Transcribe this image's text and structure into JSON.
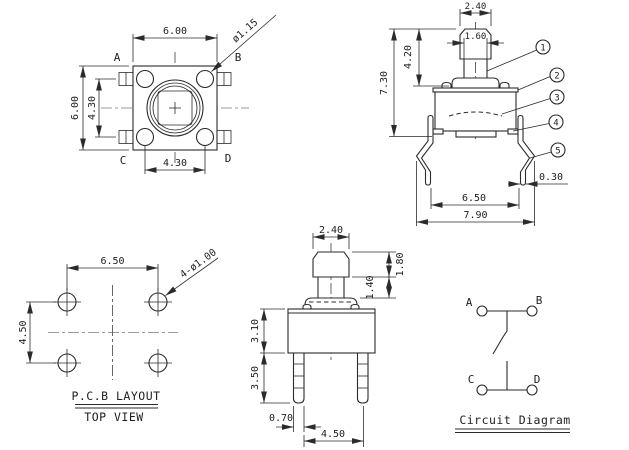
{
  "colors": {
    "line": "#2b2b2b",
    "centerline_gray": "#9a9a9a",
    "centerline_dark": "#555555",
    "background": "#ffffff"
  },
  "top_view": {
    "dim_width": "6.00",
    "dim_height": "6.00",
    "dim_pin_spacing_v": "4.30",
    "dim_pin_spacing_h": "4.30",
    "dim_actuator_dia": "ø1.15",
    "terminal_a": "A",
    "terminal_b": "B",
    "terminal_c": "C",
    "terminal_d": "D"
  },
  "front_view": {
    "dim_cap_width": "2.40",
    "dim_stem_width": "1.60",
    "dim_height_to_base": "4.20",
    "dim_total_height": "7.30",
    "dim_body_width": "6.50",
    "dim_lead_span": "7.90",
    "dim_lead_thickness": "0.30",
    "callouts": {
      "c1": "1",
      "c2": "2",
      "c3": "3",
      "c4": "4",
      "c5": "5"
    }
  },
  "pcb_layout": {
    "title": "P.C.B LAYOUT",
    "subtitle": "TOP VIEW",
    "dim_hole_spacing_h": "6.50",
    "dim_hole_spacing_v": "4.50",
    "dim_hole_callout": "4-ø1.00"
  },
  "side_view": {
    "dim_cap_width": "2.40",
    "dim_cap_height": "1.80",
    "dim_stem_height": "1.40",
    "dim_body_height": "3.10",
    "dim_lead_length": "3.50",
    "dim_lead_width": "0.70",
    "dim_lead_spacing": "4.50"
  },
  "circuit": {
    "title": "Circuit Diagram",
    "terminal_a": "A",
    "terminal_b": "B",
    "terminal_c": "C",
    "terminal_d": "D"
  }
}
